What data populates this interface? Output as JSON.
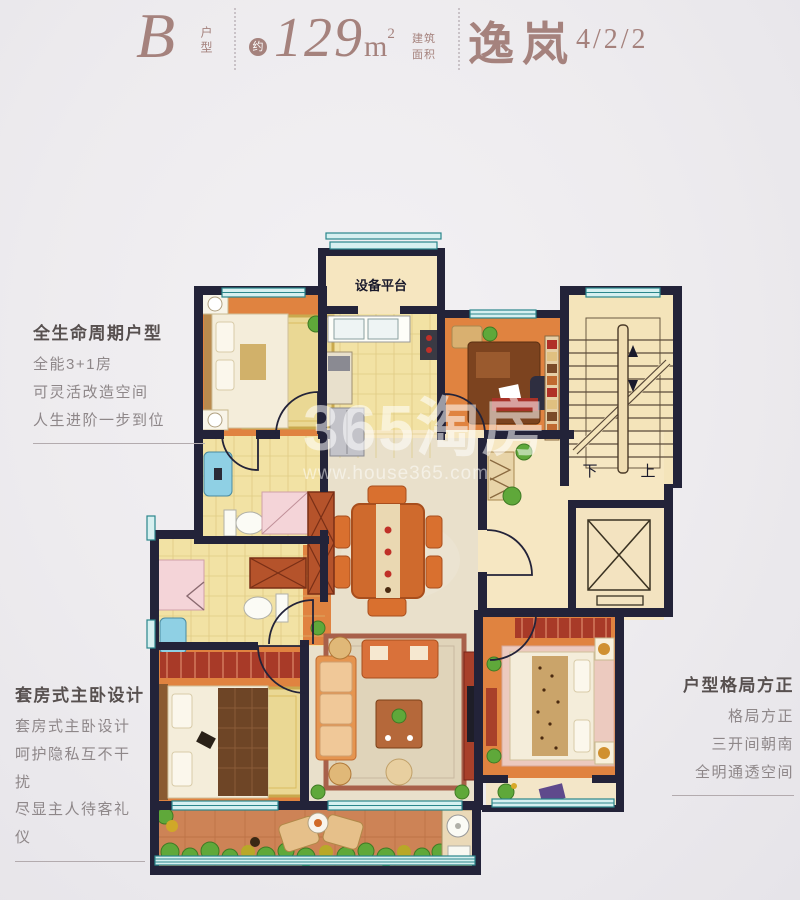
{
  "header": {
    "unit_letter": "B",
    "unit_label": "户型",
    "approx": "约",
    "area_value": "129",
    "area_unit": "m",
    "area_sup": "2",
    "area_type_top": "建筑",
    "area_type_bottom": "面积",
    "project_name": "逸岚",
    "layout_code": "4/2/2"
  },
  "annotations": {
    "left_top": {
      "title": "全生命周期户型",
      "lines": [
        "全能3+1房",
        "可灵活改造空间",
        "人生进阶一步到位"
      ]
    },
    "left_bottom": {
      "title": "套房式主卧设计",
      "lines": [
        "套房式主卧设计",
        "呵护隐私互不干扰",
        "尽显主人待客礼仪"
      ]
    },
    "right": {
      "title": "户型格局方正",
      "lines": [
        "格局方正",
        "三开间朝南",
        "全明通透空间"
      ]
    }
  },
  "floorplan": {
    "labels": {
      "equipment_platform": "设备平台",
      "stairs_down": "下",
      "stairs_up": "上"
    }
  },
  "watermark": {
    "brand": "365淘房",
    "url": "www.house365.com"
  },
  "colors": {
    "accent": "#a5827d",
    "wall": "#232339",
    "orange_floor": "#e08340",
    "yellow_floor": "#f2e2a4",
    "marble_floor": "#e9e0cb",
    "balcony_floor": "#cd8356",
    "window_teal": "#2a868b"
  }
}
